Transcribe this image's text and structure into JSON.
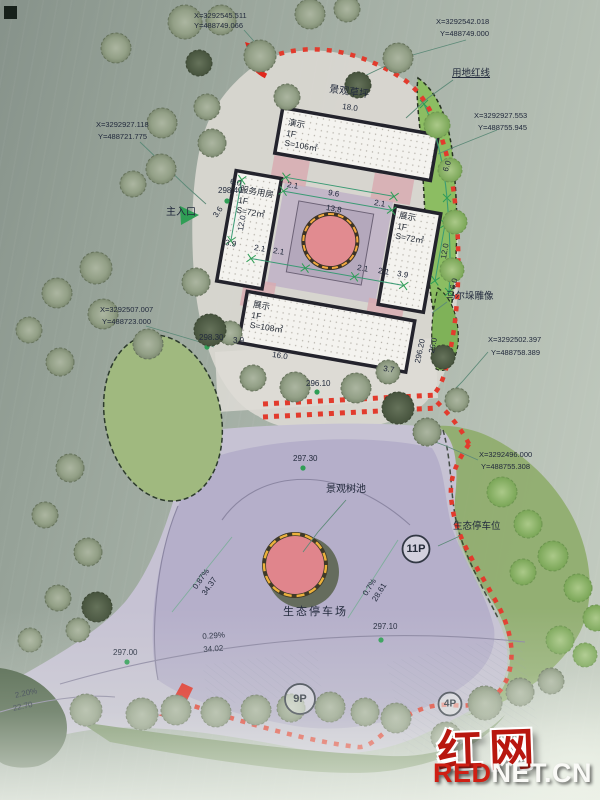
{
  "coords": {
    "tl": {
      "x": "X=3292545.511",
      "y": "Y=488749.066"
    },
    "tr": {
      "x": "X=3292542.018",
      "y": "Y=488749.000"
    },
    "ru": {
      "x": "X=3292927.553",
      "y": "Y=488755.945"
    },
    "lu": {
      "x": "X=3292927.118",
      "y": "Y=488721.775"
    },
    "lm": {
      "x": "X=3292507.007",
      "y": "Y=488723.000"
    },
    "rm": {
      "x": "X=3292502.397",
      "y": "Y=488758.389"
    },
    "rl": {
      "x": "X=3292496.000",
      "y": "Y=488755.308"
    }
  },
  "labels": {
    "red_line": "用地红线",
    "lawn": "景观草坪",
    "entrance": "主入口",
    "sculpture": "马尔垛雕像",
    "tree_pool": "景观树池",
    "eco_parking_lot": "生态停车场",
    "eco_parking_space": "生态停车位"
  },
  "buildings": {
    "north": {
      "name": "演示",
      "floor": "1F",
      "area": "S=106㎡"
    },
    "west": {
      "name": "服务用房",
      "floor": "1F",
      "area": "S=72㎡"
    },
    "east": {
      "name": "展示",
      "floor": "1F",
      "area": "S=72㎡"
    },
    "south": {
      "name": "展示",
      "floor": "1F",
      "area": "S=108㎡"
    }
  },
  "elevations": {
    "e1": "298.40",
    "e2": "298.30",
    "e3": "296.20",
    "e4": "296.10",
    "e5": "297.30",
    "e6": "297.10",
    "e7": "297.00"
  },
  "dims": {
    "d96": "9.6",
    "d138": "13.8",
    "d120": "12.0",
    "d60": "6.0",
    "d21": "2.1",
    "d39": "3.9",
    "d36": "3.6",
    "d160": "16.0",
    "d260": "26.0",
    "d37": "3.7",
    "d180": "18.0"
  },
  "slopes": {
    "s1_pct": "0.87%",
    "s1_len": "34.37",
    "s2_pct": "0.7%",
    "s2_len": "28.61",
    "s3_pct": "0.29%",
    "s3_len": "34.02",
    "s4_pct": "2.20%",
    "s4_len": "22.70"
  },
  "parking": {
    "p11": "11P",
    "p9": "9P",
    "p4": "4P"
  },
  "watermark": {
    "cn": "红网",
    "en_red": "RED",
    "en_rest": "NET.CN"
  },
  "colors": {
    "boundary_red": "#e23b2d",
    "dim_green": "#2f9e55",
    "watermark_red": "#cf1f14"
  }
}
